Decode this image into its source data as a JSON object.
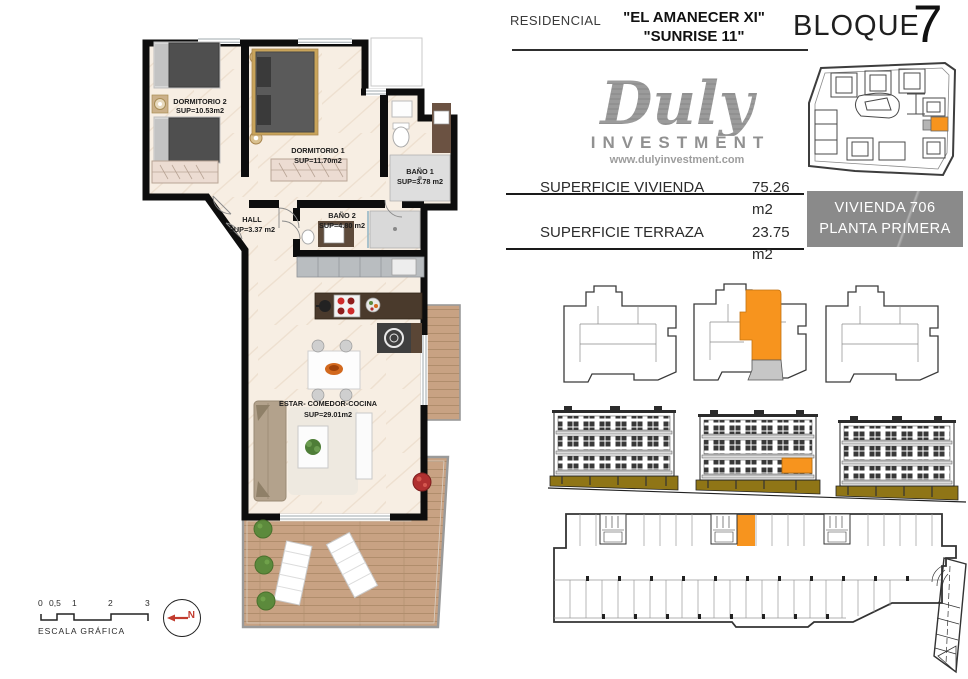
{
  "header": {
    "residencial": "RESIDENCIAL",
    "name_line1": "\"EL AMANECER XI\"",
    "name_line2": "\"SUNRISE 11\"",
    "bloque_label": "BLOQUE",
    "bloque_number": "7"
  },
  "logo": {
    "name": "Duly",
    "subtitle": "INVESTMENT",
    "website": "www.dulyinvestment.com"
  },
  "info_panel": {
    "rows": [
      {
        "label": "SUPERFICIE VIVIENDA",
        "value": "75.26 m2"
      },
      {
        "label": "SUPERFICIE TERRAZA",
        "value": "23.75 m2"
      }
    ],
    "unit_lines": [
      "VIVIENDA 706",
      "PLANTA PRIMERA"
    ]
  },
  "floor_plan": {
    "rooms": [
      {
        "name": "DORMITORIO 2",
        "sup": "SUP=10.53m2"
      },
      {
        "name": "DORMITORIO 1",
        "sup": "SUP=11.70m2"
      },
      {
        "name": "BAÑO 1",
        "sup": "SUP=3.78 m2"
      },
      {
        "name": "BAÑO 2",
        "sup": "SUP=4.80 m2"
      },
      {
        "name": "HALL",
        "sup": "SUP=3.37 m2"
      },
      {
        "name": "ESTAR-  COMEDOR-COCINA",
        "sup": "SUP=29.01m2"
      }
    ]
  },
  "scale_bar": {
    "ticks": [
      "0",
      "0,5",
      "1",
      "2",
      "3"
    ],
    "caption": "ESCALA GRÁFICA"
  },
  "north": {
    "label": "N"
  },
  "colors": {
    "highlight_orange": "#F7941E",
    "terrace_grey": "#C6C6C6",
    "olive": "#8F7516",
    "floor_cream": "#F7EEE3",
    "wood": "#C8A283",
    "wall_black": "#0D0D0D",
    "unit_box_grey": "#8A8A8A",
    "logo_grey": "#9B9B9B",
    "north_red": "#C23B2E"
  }
}
